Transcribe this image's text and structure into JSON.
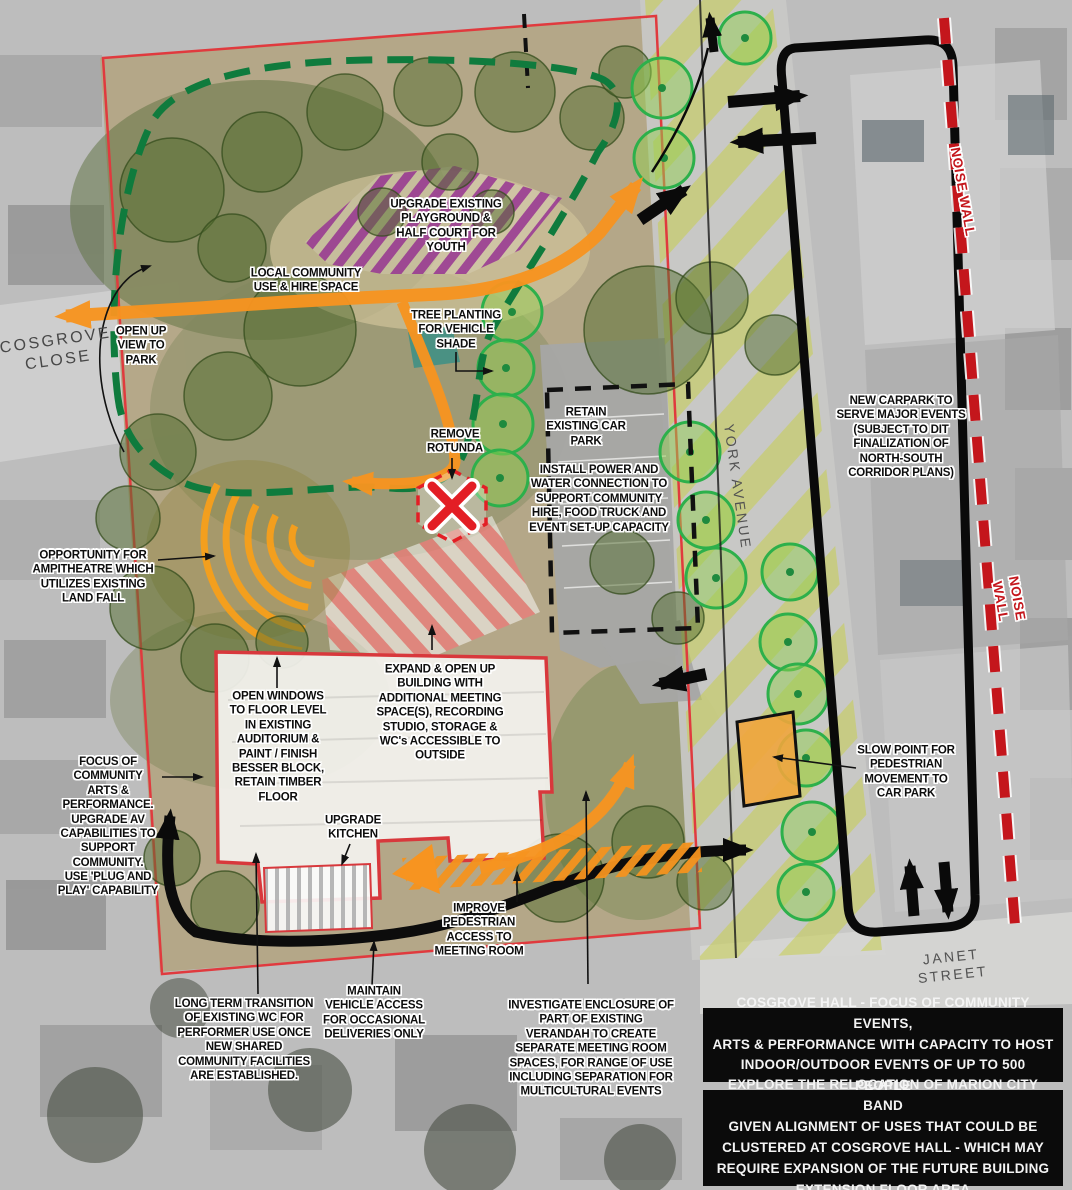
{
  "colors": {
    "accent_orange": "#F79420",
    "path_green": "#0F7B3D",
    "new_tree_green": "#2DB04B",
    "playground_purple": "#92278F",
    "alert_red": "#E31E25",
    "noise_wall_red": "#C4161C",
    "road_olive": "#C6CD4E",
    "ink_black": "#0B0B0B"
  },
  "streets": {
    "cosgrove_close": "COSGROVE\nCLOSE",
    "york_avenue": "YORK AVENUE",
    "janet_street": "JANET STREET"
  },
  "noise_wall": {
    "label": "NOISE WALL"
  },
  "annotations": {
    "playground": "UPGRADE EXISTING\nPLAYGROUND &\nHALF COURT FOR\nYOUTH",
    "local_community": "LOCAL COMMUNITY\nUSE & HIRE SPACE",
    "open_up_view": "OPEN UP\nVIEW TO\nPARK",
    "tree_planting": "TREE PLANTING\nFOR VEHICLE\nSHADE",
    "remove_rotunda": "REMOVE\nROTUNDA",
    "retain_car_park": "RETAIN\nEXISTING CAR\nPARK",
    "install_power": "INSTALL POWER AND\nWATER CONNECTION TO\nSUPPORT COMMUNITY\nHIRE, FOOD TRUCK AND\nEVENT SET-UP CAPACITY",
    "new_carpark": "NEW CARPARK TO\nSERVE MAJOR EVENTS\n(SUBJECT TO DIT\nFINALIZATION OF\nNORTH-SOUTH\nCORRIDOR PLANS)",
    "opportunity_amphitheatre": "OPPORTUNITY FOR\nAMPITHEATRE WHICH\nUTILIZES EXISTING\nLAND FALL",
    "expand_building": "EXPAND & OPEN UP\nBUILDING WITH\nADDITIONAL MEETING\nSPACE(S), RECORDING\nSTUDIO, STORAGE &\nWC's ACCESSIBLE TO\nOUTSIDE",
    "open_windows": "OPEN WINDOWS\nTO FLOOR LEVEL\nIN EXISTING\nAUDITORIUM &\nPAINT / FINISH\nBESSER BLOCK,\nRETAIN TIMBER\nFLOOR",
    "focus_arts": "FOCUS OF\nCOMMUNITY\nARTS &\nPERFORMANCE.\nUPGRADE AV\nCAPABILITIES TO\nSUPPORT\nCOMMUNITY.\nUSE 'PLUG AND\nPLAY' CAPABILITY",
    "upgrade_kitchen": "UPGRADE\nKITCHEN",
    "slow_point": "SLOW POINT FOR\nPEDESTRIAN\nMOVEMENT TO\nCAR PARK",
    "improve_pedestrian": "IMPROVE\nPEDESTRIAN\nACCESS TO\nMEETING ROOM",
    "maintain_vehicle": "MAINTAIN\nVEHICLE ACCESS\nFOR OCCASIONAL\nDELIVERIES ONLY",
    "long_term_wc": "LONG TERM TRANSITION\nOF EXISTING WC FOR\nPERFORMER USE ONCE\nNEW SHARED\nCOMMUNITY FACILITIES\nARE ESTABLISHED.",
    "investigate_verandah": "INVESTIGATE ENCLOSURE OF\nPART OF EXISTING\nVERANDAH TO CREATE\nSEPARATE MEETING ROOM\nSPACES, FOR RANGE OF USE\nINCLUDING SEPARATION FOR\nMULTICULTURAL EVENTS"
  },
  "callouts": {
    "hall_capacity": "COSGROVE HALL - FOCUS OF COMMUNITY EVENTS,\nARTS & PERFORMANCE WITH CAPACITY TO HOST\nINDOOR/OUTDOOR EVENTS OF UP TO 500 PEOPLE",
    "band_relocation": "EXPLORE THE RELOCATION OF MARION CITY BAND\nGIVEN ALIGNMENT OF USES THAT COULD BE\nCLUSTERED AT COSGROVE HALL - WHICH MAY\nREQUIRE EXPANSION OF THE FUTURE BUILDING\nEXTENSION FLOOR AREA"
  }
}
